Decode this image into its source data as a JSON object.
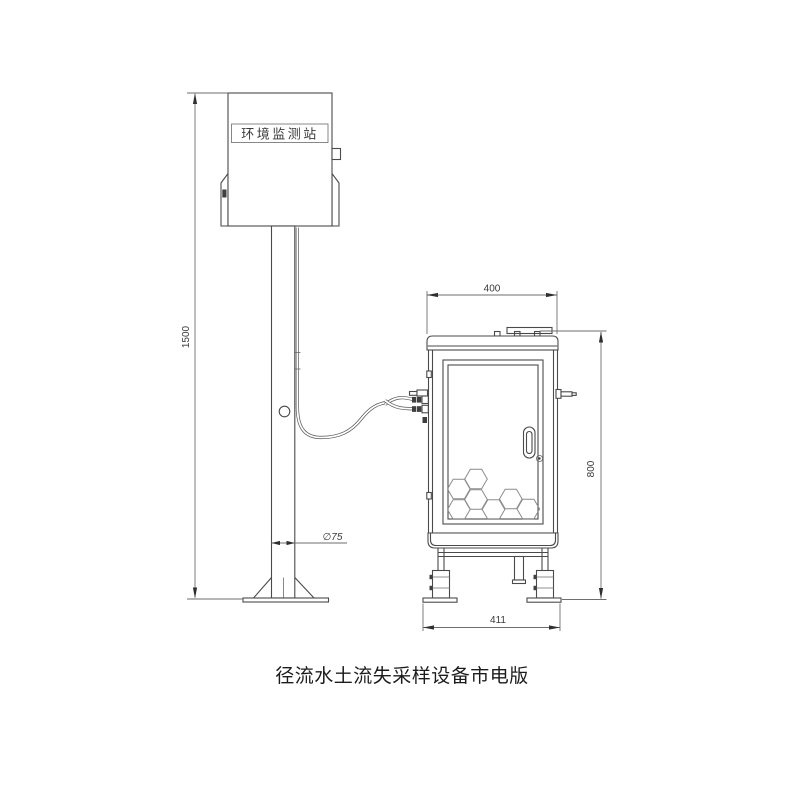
{
  "diagram": {
    "caption": "径流水土流失采样设备市电版",
    "station": {
      "label": "环境监测站"
    },
    "dimensions": {
      "pole_height": "1500",
      "pole_diameter": "∅75",
      "cabinet_top_width": "400",
      "cabinet_height": "800",
      "cabinet_base_width": "411"
    },
    "colors": {
      "line": "#4a4a4a",
      "dimension_line": "#6e6e6e",
      "text": "#2a2a2a",
      "background": "#ffffff"
    }
  }
}
